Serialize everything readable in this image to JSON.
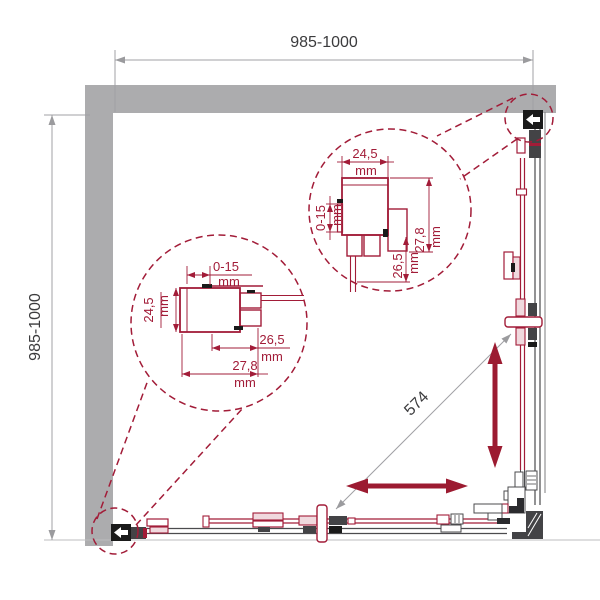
{
  "diagram": {
    "title": "shower-enclosure-square-plan-technical-drawing",
    "dimensions": {
      "width": {
        "label": "985-1000"
      },
      "depth": {
        "label": "985-1000"
      },
      "diagonal_opening": {
        "label": "574"
      }
    },
    "details": {
      "bottom_left": {
        "adjust": {
          "label": "0-15",
          "unit": "mm"
        },
        "depth": {
          "label": "24,5",
          "unit": "mm"
        },
        "inner": {
          "label": "26,5",
          "unit": "mm"
        },
        "overall": {
          "label": "27,8",
          "unit": "mm"
        }
      },
      "top_right": {
        "depth": {
          "label": "24,5",
          "unit": "mm"
        },
        "adjust": {
          "label": "0-15",
          "unit": "mm"
        },
        "inner": {
          "label": "26,5",
          "unit": "mm"
        },
        "overall": {
          "label": "27,8",
          "unit": "mm"
        }
      }
    },
    "colors": {
      "wall_gray": "#acacae",
      "profile_red": "#a21c38",
      "arrow_red": "#9c1b31",
      "dim_line_gray": "#a1a1a4",
      "text_dark": "#3b3b3d",
      "hardware_dark": "#434346",
      "hardware_black": "#1a1a1a"
    }
  }
}
